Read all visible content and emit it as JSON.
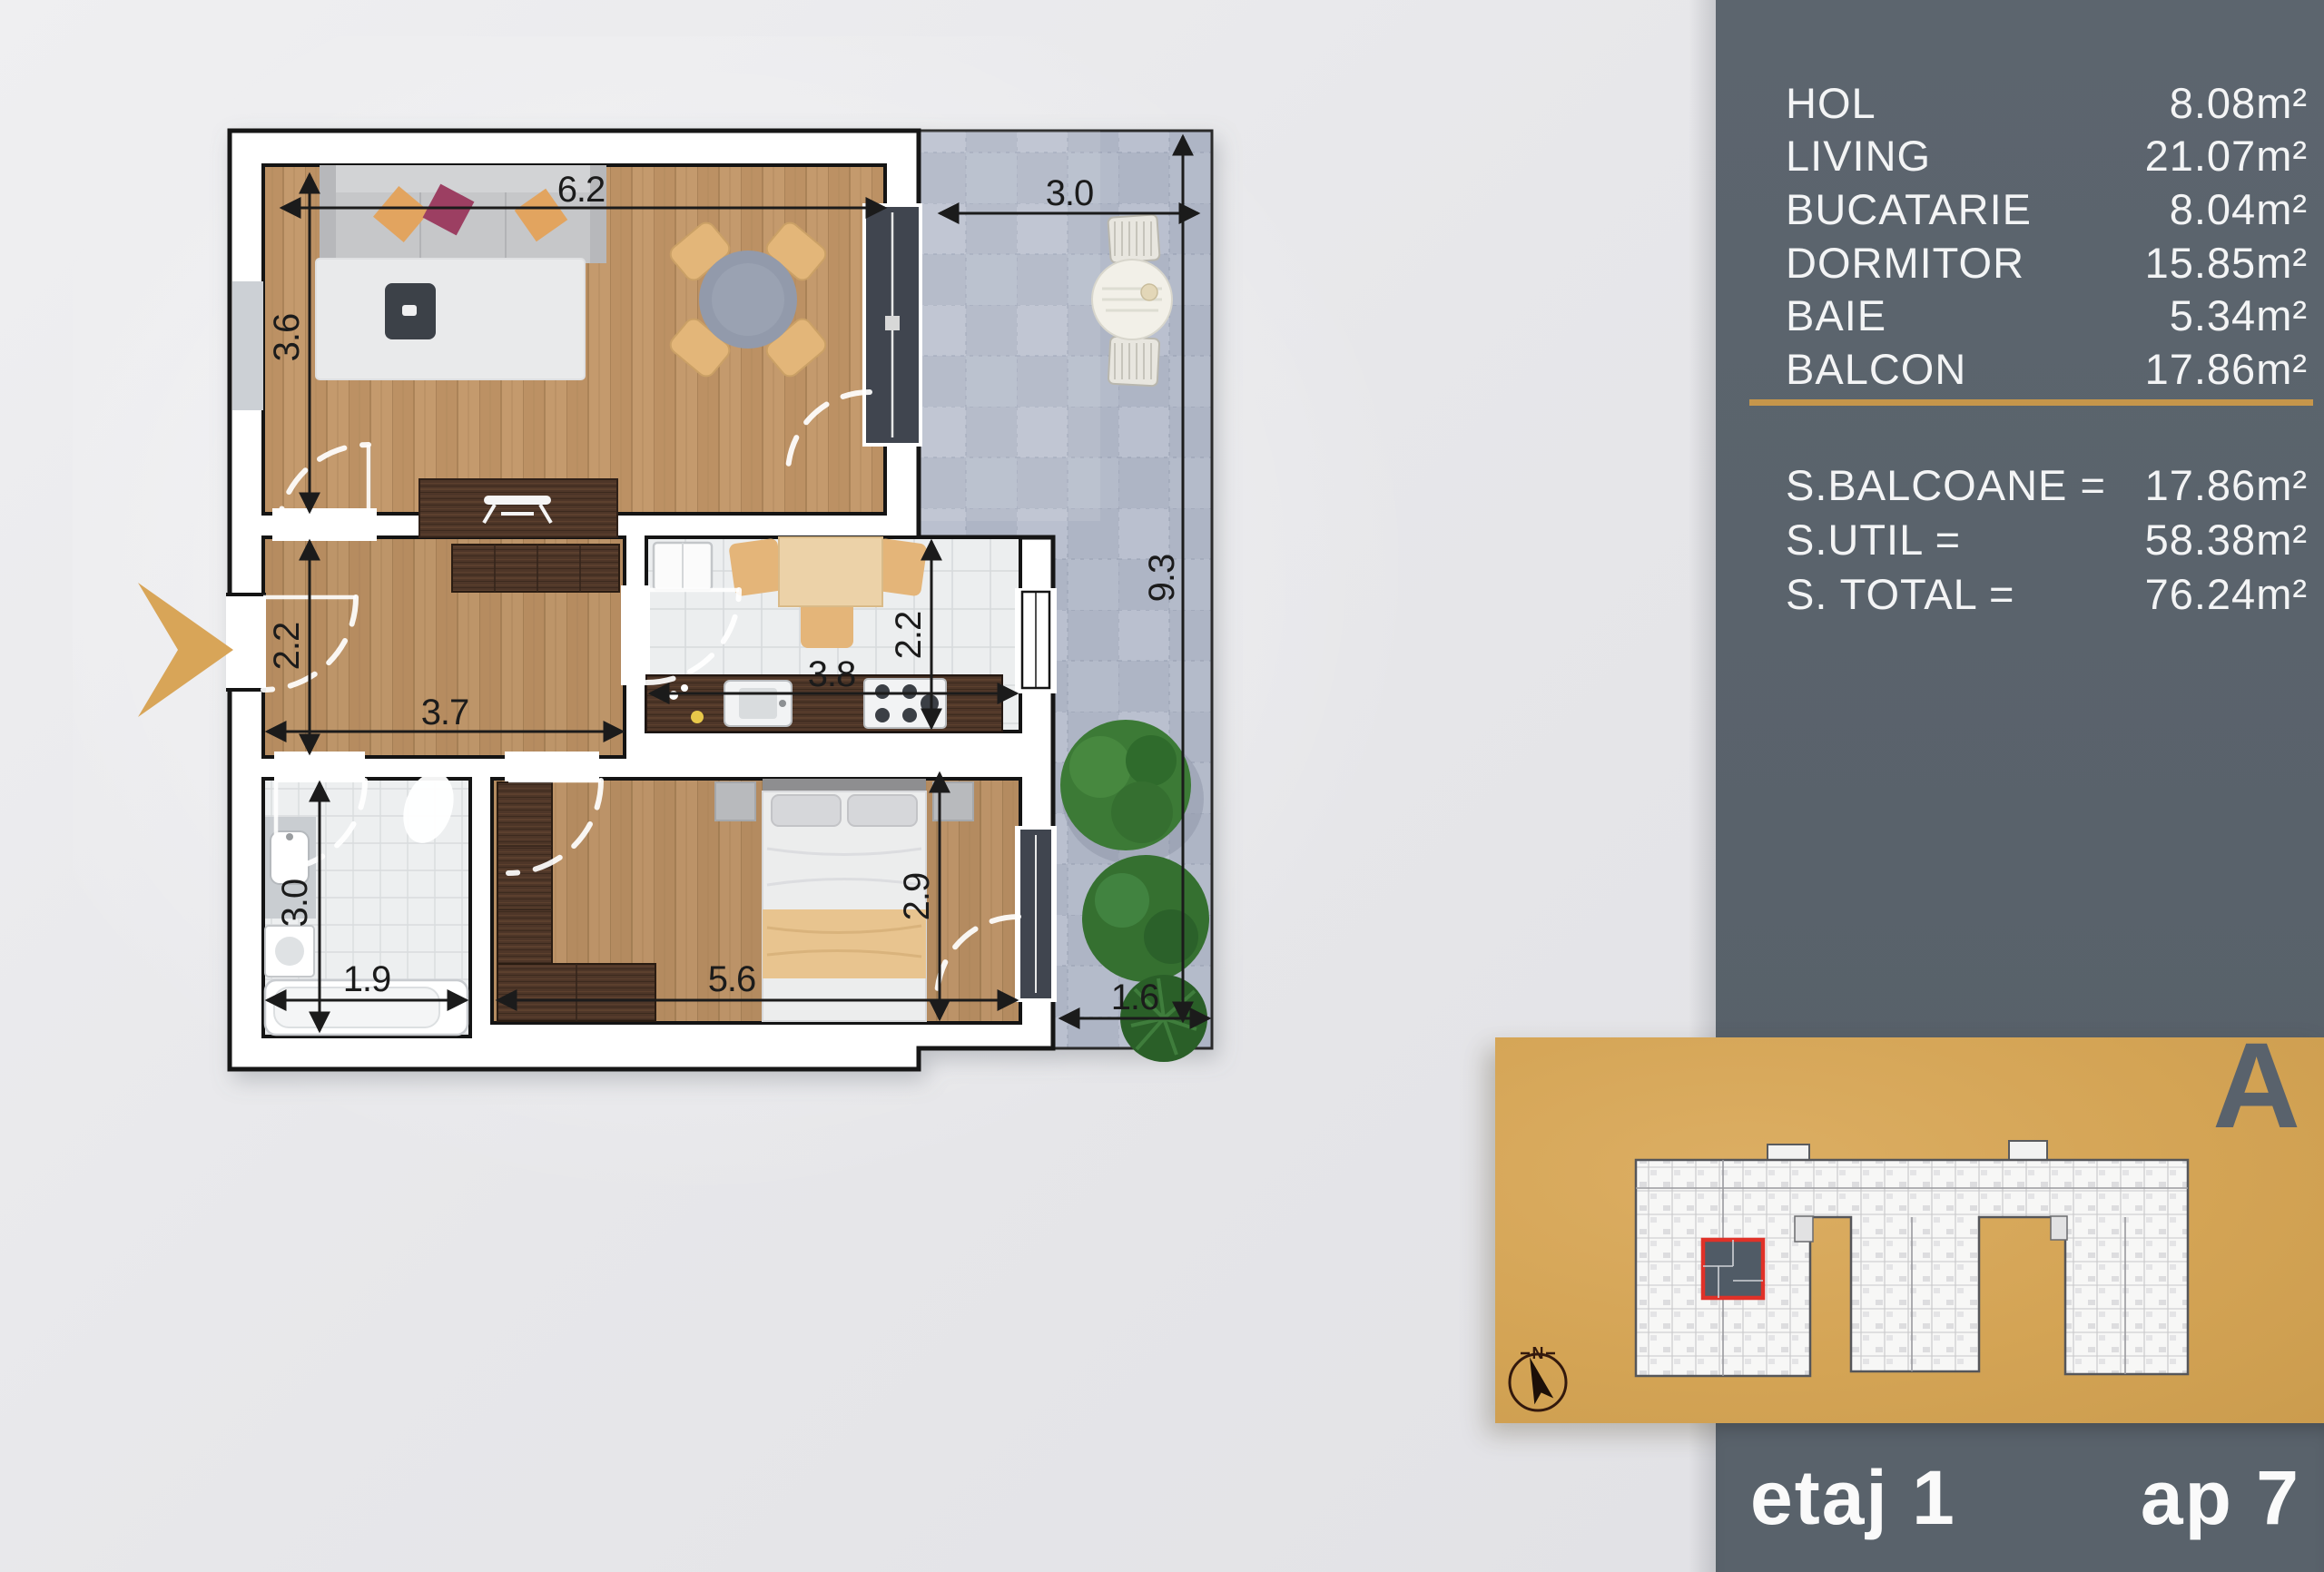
{
  "side_panel": {
    "rooms": [
      {
        "label": "HOL",
        "value": "8.08m²"
      },
      {
        "label": "LIVING",
        "value": "21.07m²"
      },
      {
        "label": "BUCATARIE",
        "value": "8.04m²"
      },
      {
        "label": "DORMITOR",
        "value": "15.85m²"
      },
      {
        "label": "BAIE",
        "value": "5.34m²"
      },
      {
        "label": "BALCON",
        "value": "17.86m²"
      }
    ],
    "totals": [
      {
        "label": "S.BALCOANE =",
        "value": "17.86m²"
      },
      {
        "label": "S.UTIL =",
        "value": "58.38m²"
      },
      {
        "label": "S. TOTAL =",
        "value": "76.24m²"
      }
    ]
  },
  "unit_locator": {
    "building_label": "A",
    "compass_label": "N"
  },
  "floor_bar": {
    "floor_label": "etaj 1",
    "apartment_label": "ap 7"
  },
  "floor_plan": {
    "dimensions": {
      "living_width": "6.2",
      "living_depth": "3.6",
      "balcony_width": "3.0",
      "balcony_length": "9.3",
      "balcony_end": "1.6",
      "hall_depth": "2.2",
      "hall_width": "3.7",
      "kitchen_width": "3.8",
      "kitchen_depth": "2.2",
      "bath_depth": "3.0",
      "bath_width": "1.9",
      "bedroom_width": "5.6",
      "bedroom_depth": "2.9"
    }
  },
  "colors": {
    "accent_gold": "#d2a155",
    "panel_bg": "#5a636c",
    "highlight_red": "#e03128",
    "balcony_tile": "#aeb5c6",
    "wood_floor": "#c29768",
    "wall_outline": "#141414"
  }
}
